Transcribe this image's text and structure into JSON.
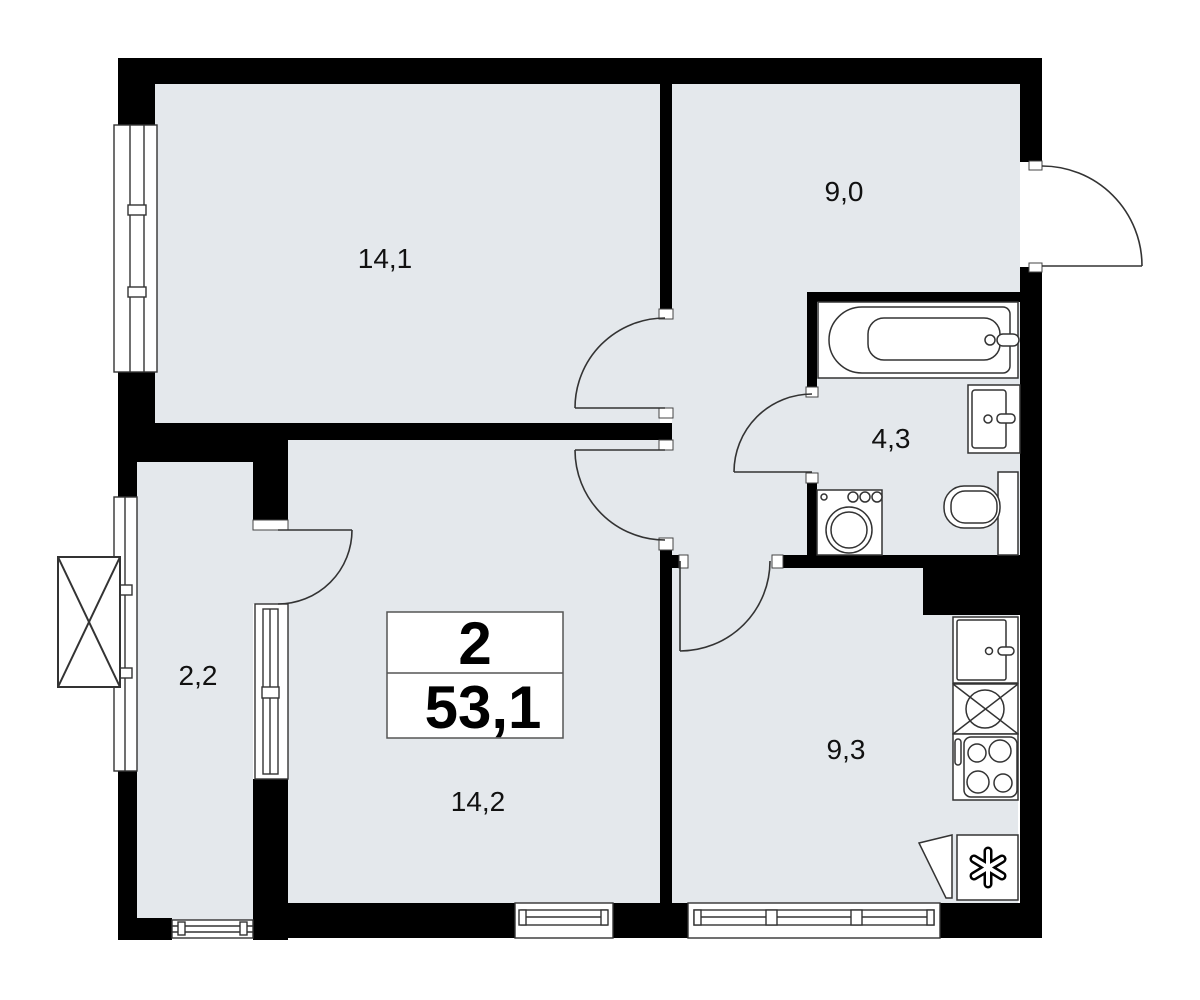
{
  "plan": {
    "info_box": {
      "rooms_count": "2",
      "total_area": "53,1"
    },
    "rooms": [
      {
        "id": "living-room",
        "area": "14,1"
      },
      {
        "id": "entrance-hall",
        "area": "9,0"
      },
      {
        "id": "bathroom",
        "area": "4,3"
      },
      {
        "id": "balcony",
        "area": "2,2"
      },
      {
        "id": "bedroom",
        "area": "14,2"
      },
      {
        "id": "kitchen",
        "area": "9,3"
      }
    ],
    "fixtures": [
      "bathtub",
      "washbasin",
      "toilet",
      "washing-machine",
      "kitchen-sink",
      "vent-shaft",
      "stove",
      "refrigerator",
      "balcony-hatch"
    ],
    "colors": {
      "floor": "#e4e8ec",
      "wall": "#000000",
      "line": "#333333",
      "white": "#ffffff"
    }
  }
}
